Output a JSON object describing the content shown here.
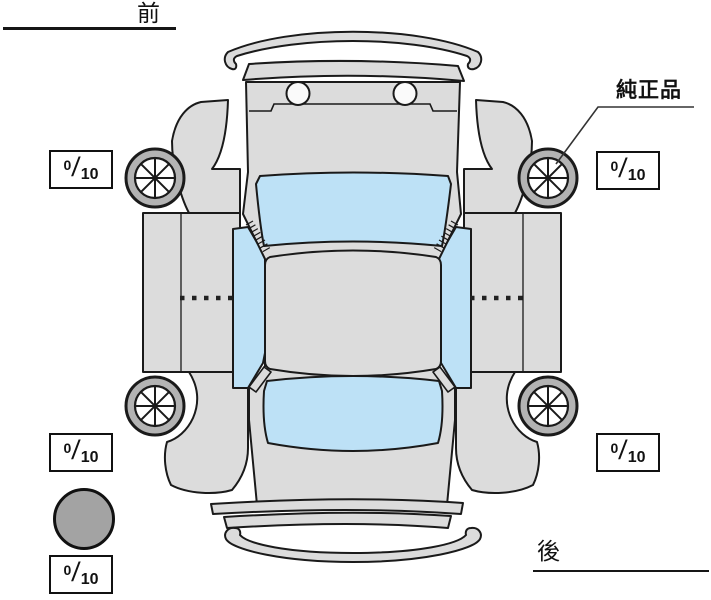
{
  "labels": {
    "front": "前",
    "rear": "後",
    "parts_annotation": "純正品"
  },
  "tread_boxes": [
    {
      "position": "front-left",
      "value": "0",
      "separator": "/",
      "max": "10"
    },
    {
      "position": "front-right",
      "value": "0",
      "separator": "/",
      "max": "10"
    },
    {
      "position": "rear-left",
      "value": "0",
      "separator": "/",
      "max": "10"
    },
    {
      "position": "rear-right",
      "value": "0",
      "separator": "/",
      "max": "10"
    },
    {
      "position": "spare",
      "value": "0",
      "separator": "/",
      "max": "10"
    }
  ],
  "colors": {
    "body_panel": "#dcdcdc",
    "glass": "#bde1f6",
    "wheel_rim": "#b3b3b3",
    "wheel_hub": "#ffffff",
    "spare_tire": "#a3a3a3",
    "outline": "#1a1a1a",
    "background": "#ffffff",
    "headlight_circle": "#fafafa"
  }
}
